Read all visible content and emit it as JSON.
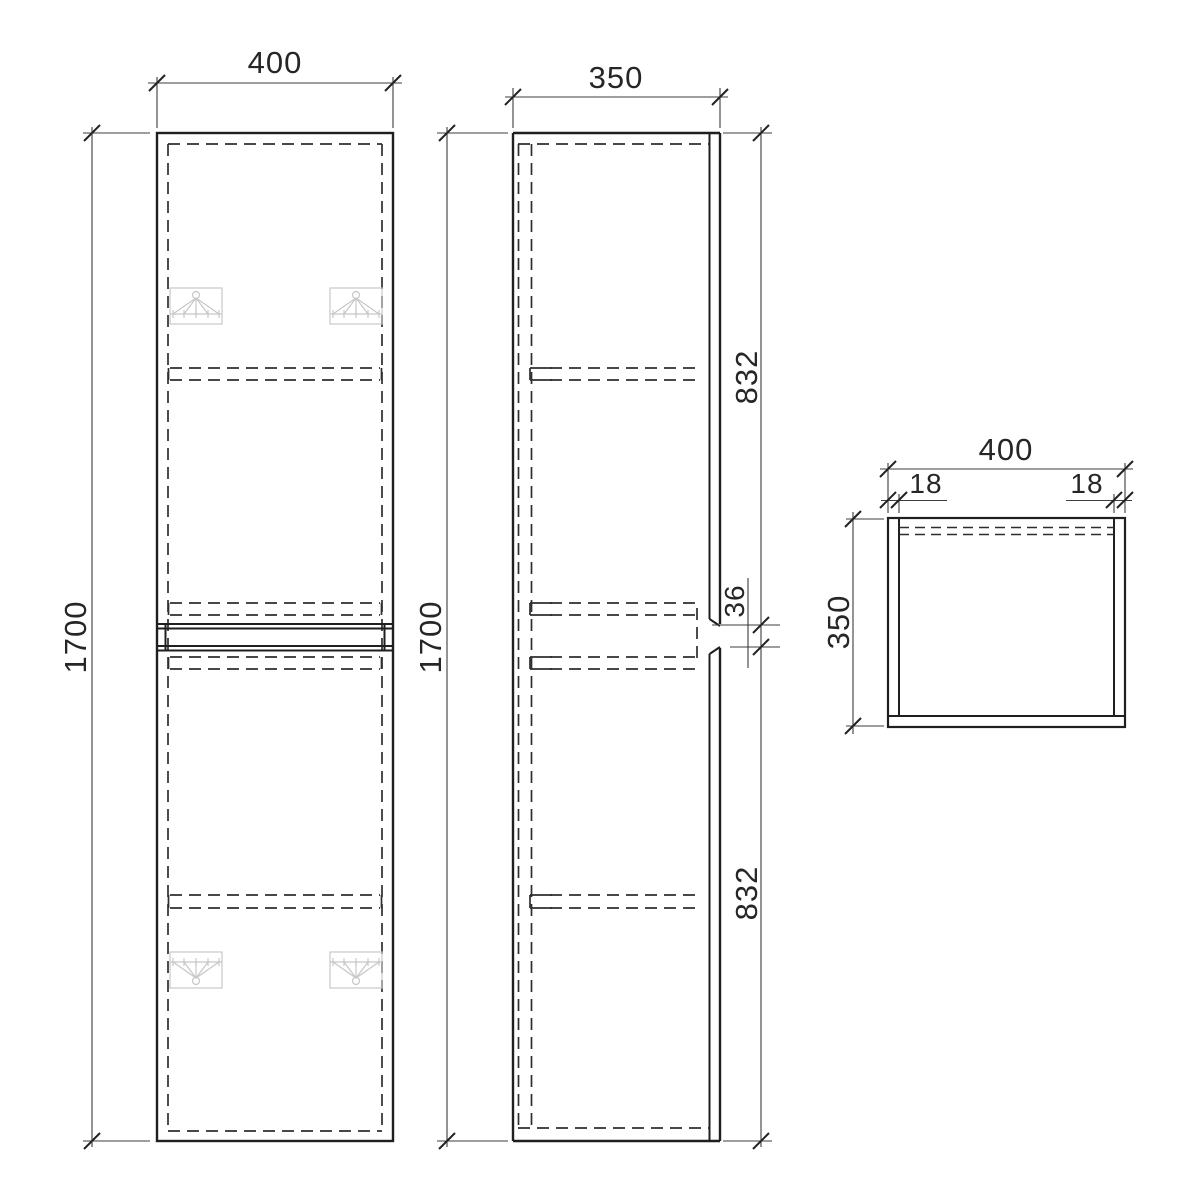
{
  "drawing": {
    "type": "technical-drawing",
    "subject": "tall two-door cabinet, three orthographic views",
    "front_view": {
      "width_dim": "400",
      "height_dim": "1700"
    },
    "side_view": {
      "depth_dim": "350",
      "height_dim": "1700",
      "upper_door_dim": "832",
      "door_gap_dim": "36",
      "lower_door_dim": "832"
    },
    "top_view": {
      "width_dim": "400",
      "left_panel_dim": "18",
      "right_panel_dim": "18",
      "depth_dim": "350"
    },
    "colors": {
      "background": "#ffffff",
      "object_line": "#1f1f1f",
      "hidden_line": "#2e2e2e",
      "dimension_line": "#3d3d3d",
      "text": "#262626",
      "bracket_symbol": "#c7c7c7"
    }
  }
}
